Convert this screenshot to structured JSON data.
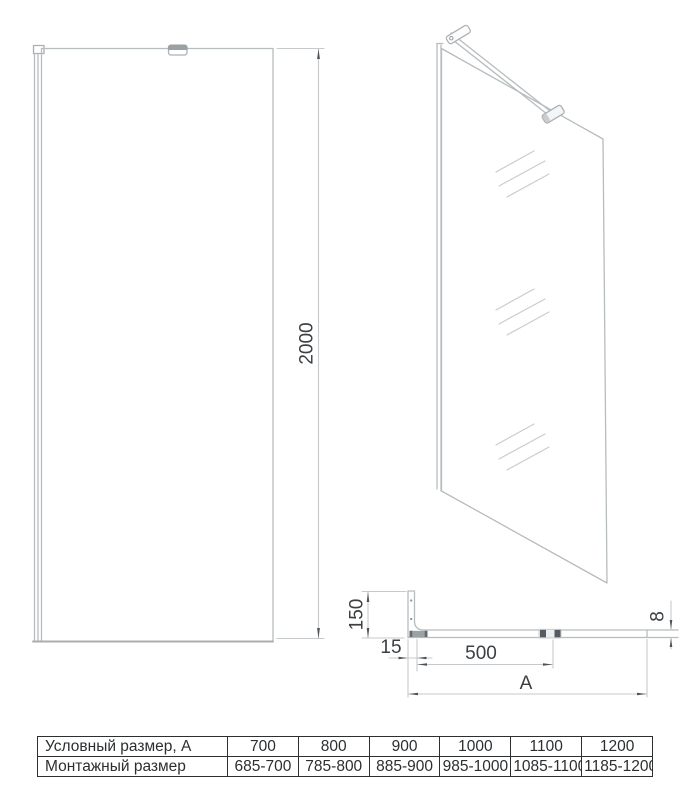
{
  "front_view": {
    "height_dim": "2000"
  },
  "plan_view": {
    "depth_dim": "150",
    "profile_width_dim": "15",
    "bar_length_dim": "500",
    "width_dim": "A",
    "glass_thickness_dim": "8"
  },
  "table": {
    "rows": [
      {
        "label": "Условный размер, А",
        "values": [
          "700",
          "800",
          "900",
          "1000",
          "1100",
          "1200"
        ]
      },
      {
        "label": "Монтажный размер",
        "values": [
          "685-700",
          "785-800",
          "885-900",
          "985-1000",
          "1085-1100",
          "1185-1200"
        ]
      }
    ]
  },
  "colors": {
    "drawing_line": "#b7bcbe",
    "dimension_dark": "#4d5357",
    "text": "#3c4043",
    "table_border": "#2c2e30",
    "hardware_gray": "#9aa1a5"
  }
}
